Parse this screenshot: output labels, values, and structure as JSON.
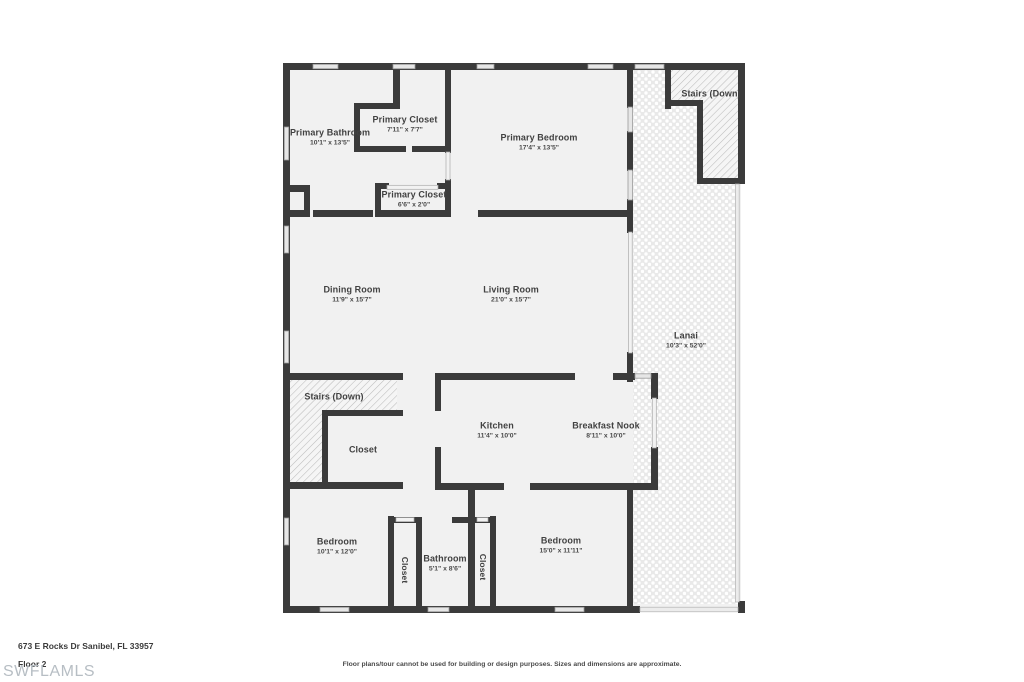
{
  "colors": {
    "wall": "#3b3b3b",
    "label_text": "#414141",
    "room_fill": "#f1f1f1",
    "watermark": "#b7bec4"
  },
  "rooms": [
    {
      "name": "Primary Bathroom",
      "dims": "10'1\" x 13'5\""
    },
    {
      "name": "Primary Closet",
      "dims": "7'11\" x 7'7\""
    },
    {
      "name": "Primary Bedroom",
      "dims": "17'4\" x 13'5\""
    },
    {
      "name": "Stairs (Down)",
      "dims": ""
    },
    {
      "name": "Primary Closet",
      "dims": "6'6\" x 2'0\""
    },
    {
      "name": "Dining Room",
      "dims": "11'9\" x 15'7\""
    },
    {
      "name": "Living Room",
      "dims": "21'0\" x 15'7\""
    },
    {
      "name": "Lanai",
      "dims": "10'3\" x 52'0\""
    },
    {
      "name": "Stairs (Down)",
      "dims": ""
    },
    {
      "name": "Closet",
      "dims": ""
    },
    {
      "name": "Kitchen",
      "dims": "11'4\" x 10'0\""
    },
    {
      "name": "Breakfast Nook",
      "dims": "8'11\" x 10'0\""
    },
    {
      "name": "Bedroom",
      "dims": "10'1\" x 12'0\""
    },
    {
      "name": "Closet",
      "dims": ""
    },
    {
      "name": "Bathroom",
      "dims": "5'1\" x 8'6\""
    },
    {
      "name": "Closet",
      "dims": ""
    },
    {
      "name": "Bedroom",
      "dims": "15'0\" x 11'11\""
    }
  ],
  "footer": {
    "address": "673 E Rocks Dr Sanibel, FL 33957",
    "floor": "Floor 2",
    "watermark": "SWFLAMLS",
    "disclaimer": "Floor plans/tour cannot be used for building or design purposes. Sizes and dimensions are approximate."
  }
}
